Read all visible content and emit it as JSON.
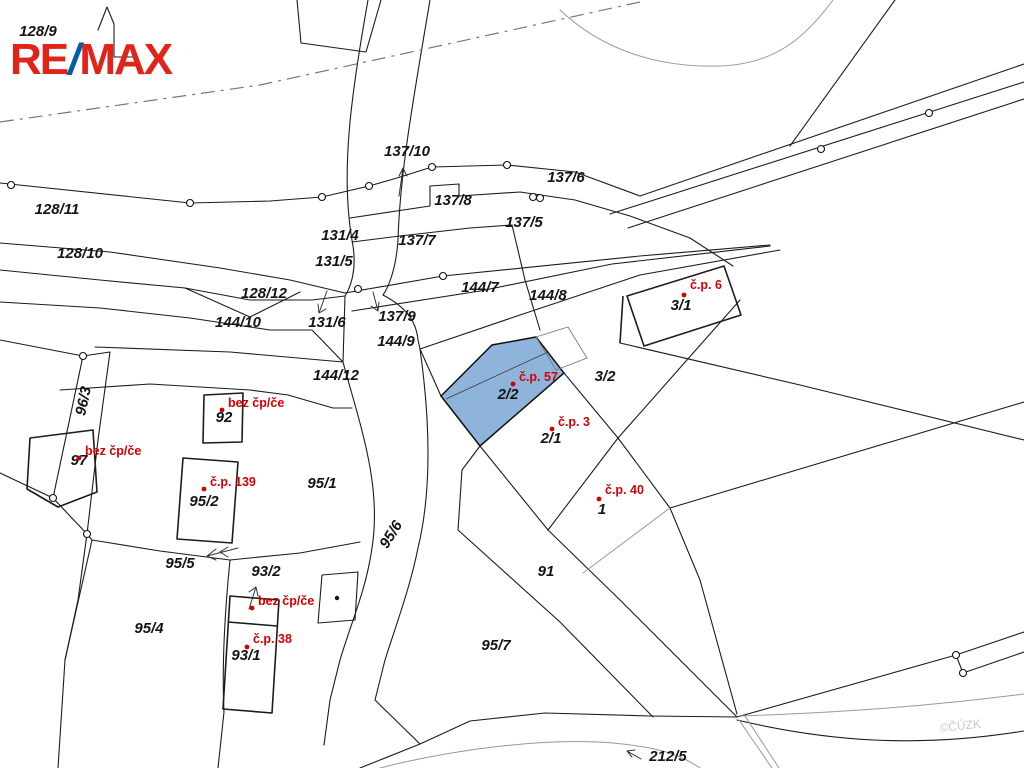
{
  "map": {
    "title": "cadastral-parcel-map",
    "logo": {
      "re": "RE",
      "slash": "/",
      "max": "MAX"
    },
    "watermark": "©ČÚZK",
    "colors": {
      "logo_red": "#e2231a",
      "logo_blue": "#005daa",
      "label_red": "#d40000",
      "highlight_blue": "#8FB4DB",
      "line": "#1c1c1c"
    },
    "highlighted_parcel": {
      "number": "2/2",
      "house_label": "č.p. 57"
    },
    "parcel_labels": [
      {
        "text": "128/9",
        "x": 38,
        "y": 36
      },
      {
        "text": "128/11",
        "x": 57,
        "y": 214
      },
      {
        "text": "128/10",
        "x": 80,
        "y": 258
      },
      {
        "text": "128/12",
        "x": 264,
        "y": 298
      },
      {
        "text": "144/10",
        "x": 238,
        "y": 327
      },
      {
        "text": "131/4",
        "x": 340,
        "y": 240
      },
      {
        "text": "131/5",
        "x": 334,
        "y": 266
      },
      {
        "text": "131/6",
        "x": 327,
        "y": 327
      },
      {
        "text": "137/10",
        "x": 407,
        "y": 156
      },
      {
        "text": "137/8",
        "x": 453,
        "y": 205
      },
      {
        "text": "137/7",
        "x": 417,
        "y": 245
      },
      {
        "text": "137/6",
        "x": 566,
        "y": 182
      },
      {
        "text": "137/5",
        "x": 524,
        "y": 227
      },
      {
        "text": "137/9",
        "x": 397,
        "y": 321
      },
      {
        "text": "144/9",
        "x": 396,
        "y": 346
      },
      {
        "text": "144/7",
        "x": 480,
        "y": 292
      },
      {
        "text": "144/8",
        "x": 548,
        "y": 300
      },
      {
        "text": "144/12",
        "x": 336,
        "y": 380
      },
      {
        "text": "3/1",
        "x": 681,
        "y": 310
      },
      {
        "text": "3/2",
        "x": 605,
        "y": 381
      },
      {
        "text": "2/2",
        "x": 508,
        "y": 399
      },
      {
        "text": "2/1",
        "x": 551,
        "y": 443
      },
      {
        "text": "1",
        "x": 602,
        "y": 514
      },
      {
        "text": "91",
        "x": 546,
        "y": 576
      },
      {
        "text": "95/1",
        "x": 322,
        "y": 488
      },
      {
        "text": "95/2",
        "x": 204,
        "y": 506
      },
      {
        "text": "95/5",
        "x": 180,
        "y": 568
      },
      {
        "text": "95/4",
        "x": 149,
        "y": 633
      },
      {
        "text": "93/2",
        "x": 266,
        "y": 576
      },
      {
        "text": "93/1",
        "x": 246,
        "y": 660
      },
      {
        "text": "95/7",
        "x": 496,
        "y": 650
      },
      {
        "text": "95/6",
        "x": 395,
        "y": 537,
        "rot": -58
      },
      {
        "text": "96/3",
        "x": 88,
        "y": 402,
        "rot": -78
      },
      {
        "text": "92",
        "x": 224,
        "y": 422
      },
      {
        "text": "97",
        "x": 79,
        "y": 465
      },
      {
        "text": "212/5",
        "x": 668,
        "y": 761
      }
    ],
    "house_number_labels": [
      {
        "text": "č.p. 6",
        "x": 690,
        "y": 289,
        "dot": [
          684,
          295
        ]
      },
      {
        "text": "č.p. 57",
        "x": 519,
        "y": 381,
        "dot": [
          513,
          384
        ]
      },
      {
        "text": "č.p. 3",
        "x": 558,
        "y": 426,
        "dot": [
          552,
          429
        ]
      },
      {
        "text": "č.p. 40",
        "x": 605,
        "y": 494,
        "dot": [
          599,
          499
        ]
      },
      {
        "text": "bez čp/če",
        "x": 85,
        "y": 455,
        "dot": [
          79,
          458
        ]
      },
      {
        "text": "bez čp/če",
        "x": 228,
        "y": 407,
        "dot": [
          222,
          410
        ]
      },
      {
        "text": "č.p. 139",
        "x": 210,
        "y": 486,
        "dot": [
          204,
          489
        ]
      },
      {
        "text": "bez čp/če",
        "x": 258,
        "y": 605,
        "dot": [
          252,
          608
        ]
      },
      {
        "text": "č.p. 38",
        "x": 253,
        "y": 643,
        "dot": [
          247,
          647
        ]
      }
    ]
  }
}
